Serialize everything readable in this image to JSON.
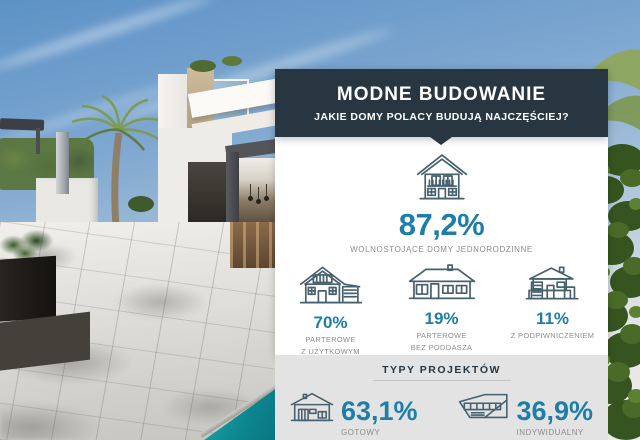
{
  "colors": {
    "header_bg": "#273641",
    "accent_blue": "#1e7ea9",
    "label_gray": "#8c8c8c",
    "footer_bg": "#e3e3e3",
    "panel_bg": "#ffffff",
    "icon_stroke": "#46606d",
    "pool_teal": "#0d8791"
  },
  "icons": {
    "main": "two-story-house-icon",
    "breakdown": [
      "attic-house-icon",
      "bungalow-house-icon",
      "basement-house-icon"
    ],
    "project_types": [
      "ready-project-house-icon",
      "individual-project-house-icon"
    ]
  },
  "infographic": {
    "header": {
      "title": "MODNE BUDOWANIE",
      "subtitle": "JAKIE DOMY POLACY BUDUJĄ NAJCZĘŚCIEJ?"
    },
    "main_stat": {
      "value": "87,2%",
      "label": "WOLNOSTOJĄCE DOMY JEDNORODZINNE"
    },
    "breakdown": [
      {
        "value": "70%",
        "line1": "PARTEROWE",
        "line2": "Z UŻYTKOWYM PODDASZEM"
      },
      {
        "value": "19%",
        "line1": "PARTEROWE",
        "line2": "BEZ PODDASZA"
      },
      {
        "value": "11%",
        "line1": "Z PODPIWNICZENIEM",
        "line2": ""
      }
    ],
    "project_types": {
      "heading": "TYPY PROJEKTÓW",
      "items": [
        {
          "value": "63,1%",
          "label": "GOTOWY"
        },
        {
          "value": "36,9%",
          "label": "INDYWIDUALNY"
        }
      ]
    }
  },
  "chart_data": {
    "type": "table",
    "title": "MODNE BUDOWANIE",
    "subtitle": "JAKIE DOMY POLACY BUDUJĄ NAJCZĘŚCIEJ?",
    "series": [
      {
        "name": "Jakie domy Polacy budują najczęściej",
        "categories": [
          "WOLNOSTOJĄCE DOMY JEDNORODZINNE",
          "PARTEROWE Z UŻYTKOWYM PODDASZEM",
          "PARTEROWE BEZ PODDASZA",
          "Z PODPIWNICZENIEM"
        ],
        "values": [
          87.2,
          70,
          19,
          11
        ],
        "unit": "%"
      },
      {
        "name": "TYPY PROJEKTÓW",
        "categories": [
          "GOTOWY",
          "INDYWIDUALNY"
        ],
        "values": [
          63.1,
          36.9
        ],
        "unit": "%"
      }
    ]
  }
}
